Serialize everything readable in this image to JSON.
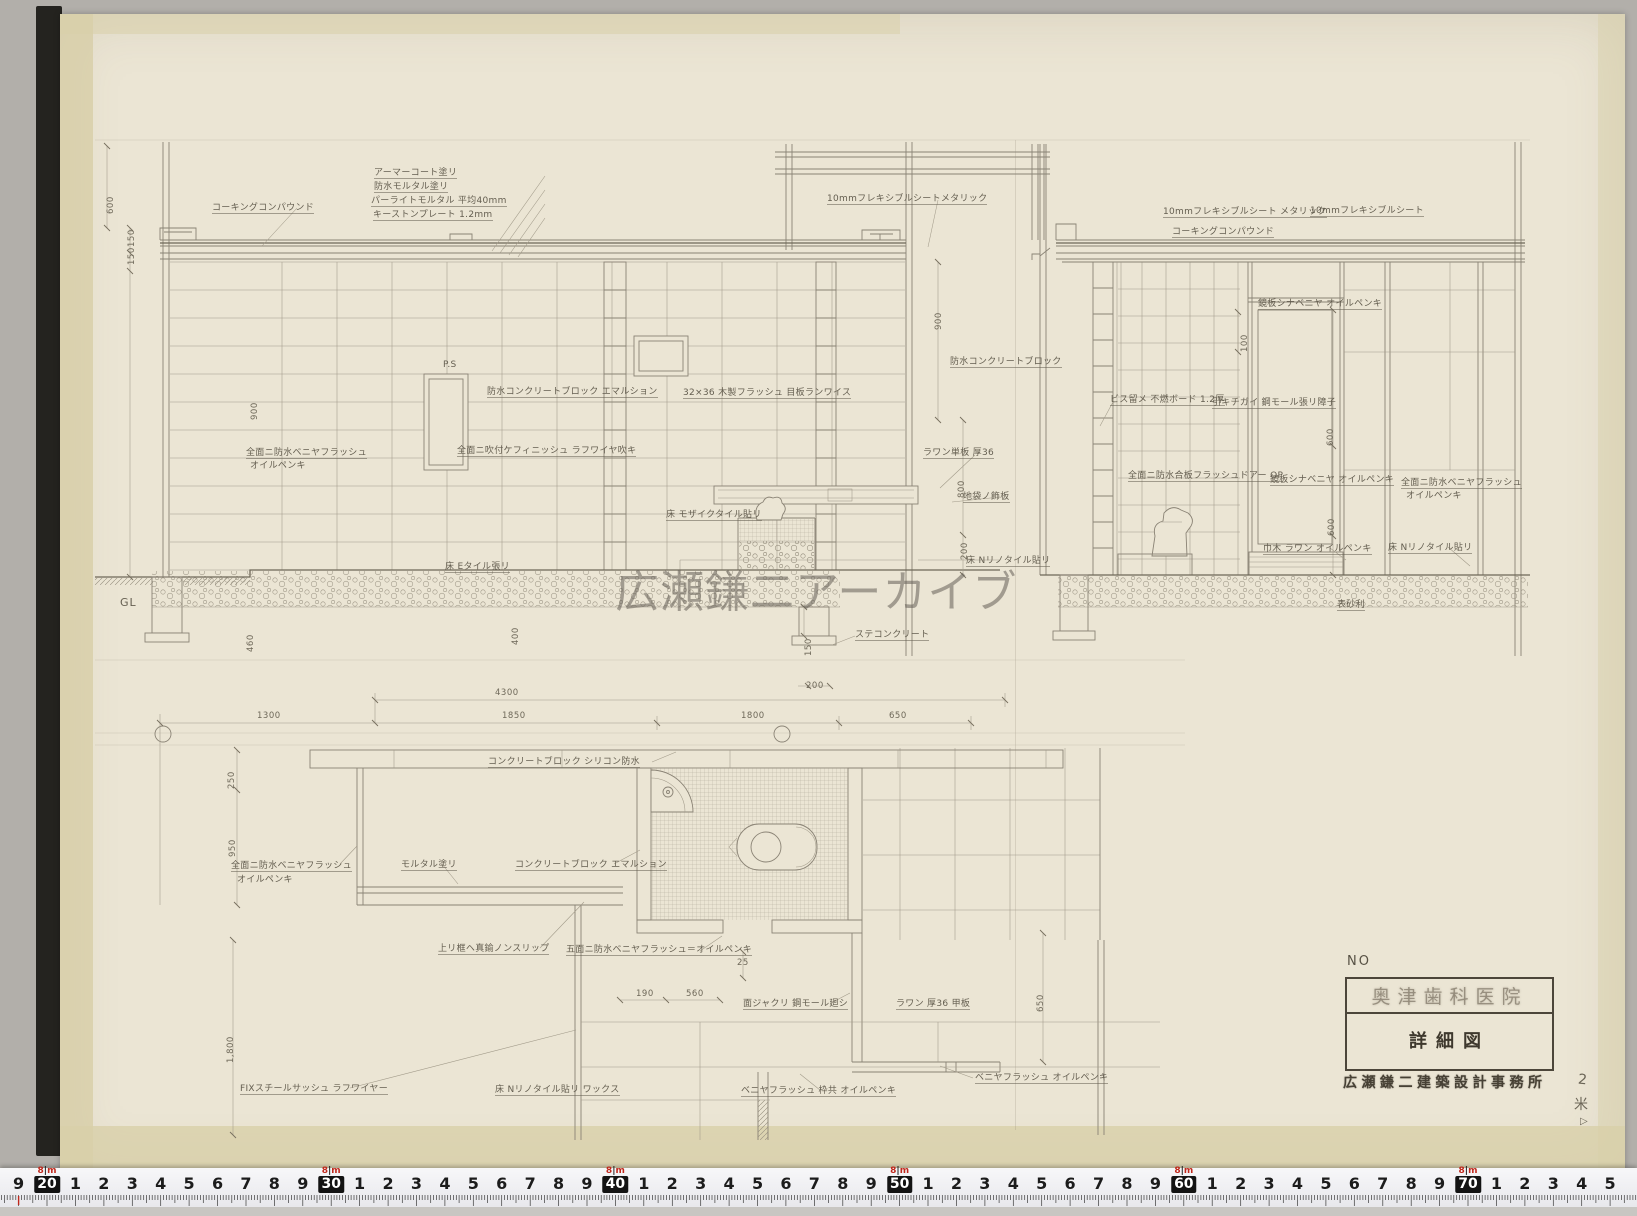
{
  "watermark": {
    "text": "広瀬鎌二アーカイブ"
  },
  "title_block": {
    "no_label": "NO",
    "project": "奥津歯科医院",
    "drawing_title": "詳細図",
    "office": "広瀬鎌二建築設計事務所"
  },
  "margin_marks": {
    "sheet_number": "2",
    "check_mark": "米",
    "flag_mark": "▷"
  },
  "ruler": {
    "lead_digit": "9",
    "decade_boxes": [
      "20",
      "30",
      "40",
      "50",
      "60",
      "70"
    ],
    "between_digits": [
      "1",
      "2",
      "3",
      "4",
      "5",
      "6",
      "7",
      "8",
      "9"
    ],
    "tail_digits": [
      "1",
      "2",
      "3",
      "4",
      "5"
    ],
    "meter_digit": "8",
    "meter_unit": "m"
  },
  "annotations": [
    {
      "t": "コーキングコンパウンド",
      "x": 212,
      "y": 203,
      "u": 1
    },
    {
      "t": "アーマーコート塗リ",
      "x": 374,
      "y": 168,
      "u": 1
    },
    {
      "t": "防水モルタル塗リ",
      "x": 374,
      "y": 182,
      "u": 1
    },
    {
      "t": "パーライトモルタル 平均40mm",
      "x": 371,
      "y": 196,
      "u": 1
    },
    {
      "t": "キーストンプレート 1.2mm",
      "x": 373,
      "y": 210,
      "u": 1
    },
    {
      "t": "10mmフレキシブルシートメタリック",
      "x": 827,
      "y": 194,
      "u": 1
    },
    {
      "t": "P.S",
      "x": 443,
      "y": 360
    },
    {
      "t": "防水コンクリートブロック エマルション",
      "x": 487,
      "y": 387,
      "u": 1
    },
    {
      "t": "全面ニ吹付ケフィニッシュ ラフワイヤ吹キ",
      "x": 457,
      "y": 446,
      "u": 1
    },
    {
      "t": "全面ニ防水ベニヤフラッシュ",
      "x": 246,
      "y": 448,
      "u": 1
    },
    {
      "t": "オイルペンキ",
      "x": 250,
      "y": 461
    },
    {
      "t": "32×36 木製フラッシュ 目板ランワイス",
      "x": 683,
      "y": 388,
      "u": 1
    },
    {
      "t": "防水コンクリートブロック",
      "x": 950,
      "y": 357,
      "u": 1
    },
    {
      "t": "ラワン単板 厚36",
      "x": 923,
      "y": 448,
      "u": 1
    },
    {
      "t": "地袋ノ飾板",
      "x": 963,
      "y": 492,
      "u": 1
    },
    {
      "t": "床 モザイクタイル貼リ",
      "x": 666,
      "y": 510,
      "u": 1
    },
    {
      "t": "床 Eタイル張リ",
      "x": 445,
      "y": 562,
      "u": 1
    },
    {
      "t": "GL",
      "x": 120,
      "y": 598,
      "big": 1
    },
    {
      "t": "ステコンクリート",
      "x": 855,
      "y": 630,
      "u": 1
    },
    {
      "t": "床 Nリノタイル貼リ",
      "x": 966,
      "y": 556,
      "u": 1
    },
    {
      "t": "10mmフレキシブルシート メタリック",
      "x": 1163,
      "y": 207,
      "u": 1
    },
    {
      "t": "コーキングコンパウンド",
      "x": 1172,
      "y": 227,
      "u": 1
    },
    {
      "t": "10mmフレキシブルシート",
      "x": 1310,
      "y": 206,
      "u": 1
    },
    {
      "t": "鏡板シナベニヤ オイルペンキ",
      "x": 1258,
      "y": 299,
      "u": 1
    },
    {
      "t": "ビス留メ 不燃ボード 1.2厚",
      "x": 1110,
      "y": 395,
      "u": 1
    },
    {
      "t": "引キチガイ 鋼モール張リ障子",
      "x": 1212,
      "y": 398,
      "u": 1
    },
    {
      "t": "全面ニ防水合板フラッシュドアー OP",
      "x": 1128,
      "y": 471,
      "u": 1
    },
    {
      "t": "鏡板シナベニヤ オイルペンキ",
      "x": 1270,
      "y": 475,
      "u": 1
    },
    {
      "t": "全面ニ防水ベニヤフラッシュ",
      "x": 1401,
      "y": 478,
      "u": 1
    },
    {
      "t": "オイルペンキ",
      "x": 1406,
      "y": 491
    },
    {
      "t": "巾木 ラワン オイルペンキ",
      "x": 1263,
      "y": 544,
      "u": 1
    },
    {
      "t": "床 Nリノタイル貼リ",
      "x": 1388,
      "y": 543,
      "u": 1
    },
    {
      "t": "表砂利",
      "x": 1337,
      "y": 600,
      "u": 1
    },
    {
      "t": "コンクリートブロック シリコン防水",
      "x": 488,
      "y": 757,
      "u": 1
    },
    {
      "t": "全面ニ防水ベニヤフラッシュ",
      "x": 231,
      "y": 861,
      "u": 1
    },
    {
      "t": "オイルペンキ",
      "x": 237,
      "y": 875
    },
    {
      "t": "モルタル塗リ",
      "x": 401,
      "y": 860,
      "u": 1
    },
    {
      "t": "コンクリートブロック エマルション",
      "x": 515,
      "y": 860,
      "u": 1
    },
    {
      "t": "上リ框ヘ真鍮ノンスリップ",
      "x": 438,
      "y": 944,
      "u": 1
    },
    {
      "t": "五面ニ防水ベニヤフラッシュ＝オイルペンキ",
      "x": 566,
      "y": 945,
      "u": 1
    },
    {
      "t": "面ジャクリ 鋼モール廻シ",
      "x": 743,
      "y": 999,
      "u": 1
    },
    {
      "t": "ラワン 厚36 甲板",
      "x": 896,
      "y": 999,
      "u": 1
    },
    {
      "t": "ベニヤフラッシュ オイルペンキ",
      "x": 975,
      "y": 1073,
      "u": 1
    },
    {
      "t": "ベニヤフラッシュ 枠共 オイルペンキ",
      "x": 741,
      "y": 1086,
      "u": 1
    },
    {
      "t": "FIXスチールサッシュ ラフワイヤー",
      "x": 240,
      "y": 1084,
      "u": 1
    },
    {
      "t": "床 Nリノタイル貼リ ワックス",
      "x": 495,
      "y": 1085,
      "u": 1
    },
    {
      "t": "4300",
      "x": 495,
      "y": 688,
      "c": "dim"
    },
    {
      "t": "1300",
      "x": 257,
      "y": 711,
      "c": "dim"
    },
    {
      "t": "1850",
      "x": 502,
      "y": 711,
      "c": "dim"
    },
    {
      "t": "1800",
      "x": 741,
      "y": 711,
      "c": "dim"
    },
    {
      "t": "650",
      "x": 889,
      "y": 711,
      "c": "dim"
    },
    {
      "t": "25",
      "x": 737,
      "y": 958,
      "c": "dim"
    },
    {
      "t": "190",
      "x": 636,
      "y": 989,
      "c": "dim"
    },
    {
      "t": "560",
      "x": 686,
      "y": 989,
      "c": "dim"
    },
    {
      "t": "200",
      "x": 806,
      "y": 681,
      "c": "dim"
    },
    {
      "t": "600",
      "x": 106,
      "y": 214,
      "r": 1,
      "c": "dim"
    },
    {
      "t": "150",
      "x": 127,
      "y": 247,
      "r": 1,
      "c": "dim"
    },
    {
      "t": "150",
      "x": 127,
      "y": 265,
      "r": 1,
      "c": "dim"
    },
    {
      "t": "900",
      "x": 250,
      "y": 420,
      "r": 1,
      "c": "dim"
    },
    {
      "t": "150",
      "x": 804,
      "y": 656,
      "r": 1,
      "c": "dim"
    },
    {
      "t": "460",
      "x": 246,
      "y": 652,
      "r": 1,
      "c": "dim"
    },
    {
      "t": "400",
      "x": 511,
      "y": 645,
      "r": 1,
      "c": "dim"
    },
    {
      "t": "250",
      "x": 227,
      "y": 789,
      "r": 1,
      "c": "dim"
    },
    {
      "t": "950",
      "x": 228,
      "y": 857,
      "r": 1,
      "c": "dim"
    },
    {
      "t": "1,800",
      "x": 226,
      "y": 1063,
      "r": 1,
      "c": "dim"
    },
    {
      "t": "650",
      "x": 1036,
      "y": 1012,
      "r": 1,
      "c": "dim"
    },
    {
      "t": "800",
      "x": 957,
      "y": 498,
      "r": 1,
      "c": "dim"
    },
    {
      "t": "200",
      "x": 960,
      "y": 560,
      "r": 1,
      "c": "dim"
    },
    {
      "t": "900",
      "x": 934,
      "y": 330,
      "r": 1,
      "c": "dim"
    },
    {
      "t": "100",
      "x": 1240,
      "y": 352,
      "r": 1,
      "c": "dim"
    },
    {
      "t": "600",
      "x": 1326,
      "y": 446,
      "r": 1,
      "c": "dim"
    },
    {
      "t": "600",
      "x": 1327,
      "y": 536,
      "r": 1,
      "c": "dim"
    }
  ]
}
